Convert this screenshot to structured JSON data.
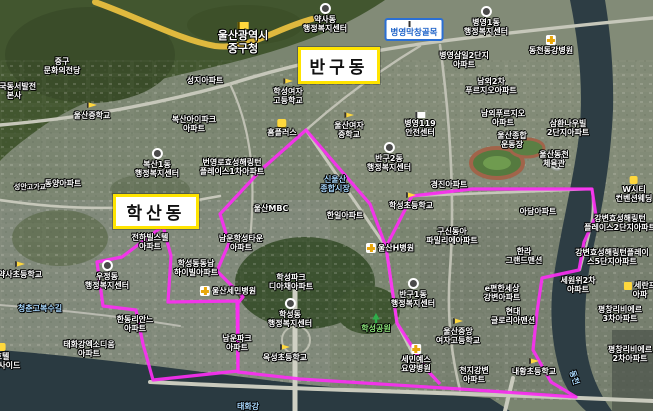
{
  "map": {
    "width": 653,
    "height": 411,
    "description": "satellite-map-ulsan-junggu"
  },
  "colors": {
    "boundary": "#fb2ef2",
    "district_box_border": "#ffe400",
    "district_box_bg": "#ffffff",
    "label_white": "#ffffff",
    "label_blue": "#a9d9ff",
    "label_green": "#8fe97d",
    "road_yellow": "#dfb93e",
    "road_gray": "#c6c7ba",
    "water": "#2a3a41"
  },
  "district_boxes": [
    {
      "name": "bangu-dong-box",
      "label": "반구동",
      "x": 298,
      "y": 47,
      "w": 76,
      "h": 31
    },
    {
      "name": "haksan-dong-box",
      "label": "학산동",
      "x": 113,
      "y": 194,
      "w": 80,
      "h": 29
    }
  ],
  "boundaries": [
    {
      "name": "haksan-dong-boundary",
      "closed": true,
      "points": [
        [
          163,
          226
        ],
        [
          171,
          256
        ],
        [
          168,
          302
        ],
        [
          237,
          301
        ],
        [
          238,
          371
        ],
        [
          153,
          380
        ],
        [
          143,
          344
        ],
        [
          136,
          310
        ],
        [
          103,
          306
        ],
        [
          97,
          262
        ],
        [
          122,
          257
        ]
      ]
    },
    {
      "name": "bangu-dong-boundary",
      "closed": true,
      "points": [
        [
          306,
          130
        ],
        [
          370,
          204
        ],
        [
          386,
          247
        ],
        [
          412,
          196
        ],
        [
          472,
          189
        ],
        [
          592,
          189
        ],
        [
          596,
          216
        ],
        [
          584,
          242
        ],
        [
          579,
          270
        ],
        [
          542,
          278
        ],
        [
          537,
          312
        ],
        [
          533,
          350
        ],
        [
          551,
          382
        ],
        [
          576,
          397
        ],
        [
          460,
          389
        ],
        [
          300,
          379
        ],
        [
          238,
          372
        ],
        [
          238,
          303
        ],
        [
          243,
          297
        ],
        [
          217,
          271
        ],
        [
          229,
          243
        ],
        [
          220,
          214
        ],
        [
          262,
          169
        ]
      ]
    },
    {
      "name": "bangu-inner-divider",
      "closed": false,
      "points": [
        [
          386,
          247
        ],
        [
          393,
          295
        ],
        [
          397,
          323
        ],
        [
          427,
          370
        ],
        [
          440,
          384
        ]
      ]
    }
  ],
  "labels": [
    {
      "text": [
        "중구",
        "문화의전당"
      ],
      "x": 62,
      "y": 57
    },
    {
      "text": [
        "한국동서발전",
        "본사"
      ],
      "x": 14,
      "y": 82
    },
    {
      "text": [
        "울산중학교"
      ],
      "x": 92,
      "y": 102,
      "icon": "school"
    },
    {
      "text": [
        "성지아파트"
      ],
      "x": 205,
      "y": 76
    },
    {
      "text": [
        "복산아이파크",
        "아파트"
      ],
      "x": 194,
      "y": 115
    },
    {
      "text": [
        "울산광역시",
        "중구청"
      ],
      "x": 243,
      "y": 22,
      "size": 11,
      "icon": "gov"
    },
    {
      "text": [
        "약사동",
        "행정복지센터"
      ],
      "x": 325,
      "y": 3,
      "icon": "office"
    },
    {
      "text": [
        "병영막창골목"
      ],
      "x": 414,
      "y": 18,
      "icon": "flag",
      "box": "blue"
    },
    {
      "text": [
        "병영1동",
        "행정복지센터"
      ],
      "x": 486,
      "y": 6,
      "icon": "office"
    },
    {
      "text": [
        "동천동강병원"
      ],
      "x": 551,
      "y": 35,
      "icon": "hospital"
    },
    {
      "text": [
        "병영삼일2단지",
        "아파트"
      ],
      "x": 464,
      "y": 51
    },
    {
      "text": [
        "남외2차",
        "푸르지오아파트"
      ],
      "x": 491,
      "y": 77
    },
    {
      "text": [
        "남외푸르지오",
        "아파트"
      ],
      "x": 503,
      "y": 109
    },
    {
      "text": [
        "삼환나우빌",
        "2단지아파트"
      ],
      "x": 568,
      "y": 119
    },
    {
      "text": [
        "울산종합",
        "운동장"
      ],
      "x": 512,
      "y": 131
    },
    {
      "text": [
        "울산동천",
        "체육관"
      ],
      "x": 554,
      "y": 150
    },
    {
      "text": [
        "학성여자",
        "고등학교"
      ],
      "x": 288,
      "y": 78,
      "icon": "school"
    },
    {
      "text": [
        "울산여자",
        "중학교"
      ],
      "x": 349,
      "y": 112,
      "icon": "school"
    },
    {
      "text": [
        "홈플러스"
      ],
      "x": 282,
      "y": 119,
      "icon": "cart"
    },
    {
      "text": [
        "병영119",
        "안전센터"
      ],
      "x": 420,
      "y": 112,
      "icon": "flag"
    },
    {
      "text": [
        "반구2동",
        "행정복지센터"
      ],
      "x": 389,
      "y": 142,
      "icon": "office"
    },
    {
      "text": [
        "경진아파트"
      ],
      "x": 449,
      "y": 180
    },
    {
      "text": [
        "W시티",
        "컨벤션웨딩"
      ],
      "x": 634,
      "y": 176,
      "icon": "hotel"
    },
    {
      "text": [
        "복산1동",
        "행정복지센터"
      ],
      "x": 157,
      "y": 148,
      "icon": "office"
    },
    {
      "text": [
        "번영로효성해링턴",
        "플레이스1차아파트"
      ],
      "x": 232,
      "y": 158
    },
    {
      "text": [
        "동양아파트"
      ],
      "x": 63,
      "y": 179
    },
    {
      "text": [
        "성안고가교"
      ],
      "x": 30,
      "y": 183,
      "size": 7
    },
    {
      "text": [
        "울산MBC"
      ],
      "x": 271,
      "y": 204
    },
    {
      "text": [
        "신울산",
        "종합시장"
      ],
      "x": 335,
      "y": 175,
      "color": "blue"
    },
    {
      "text": [
        "한일아파트"
      ],
      "x": 345,
      "y": 211
    },
    {
      "text": [
        "학성초등학교"
      ],
      "x": 411,
      "y": 192,
      "icon": "school"
    },
    {
      "text": [
        "구신동아",
        "파밀리에아파트"
      ],
      "x": 452,
      "y": 227
    },
    {
      "text": [
        "울산H병원"
      ],
      "x": 390,
      "y": 243,
      "icon": "hospital-left"
    },
    {
      "text": [
        "아담아파트"
      ],
      "x": 538,
      "y": 207
    },
    {
      "text": [
        "강변효성해링턴",
        "플레이스2단지아파트"
      ],
      "x": 620,
      "y": 214
    },
    {
      "text": [
        "강변효성해링턴플레이",
        "스5단지아파트"
      ],
      "x": 612,
      "y": 248
    },
    {
      "text": [
        "한라",
        "그랜드맨션"
      ],
      "x": 524,
      "y": 247
    },
    {
      "text": [
        "세원위2차",
        "아파트"
      ],
      "x": 578,
      "y": 276
    },
    {
      "text": [
        "세란프",
        "아파"
      ],
      "x": 640,
      "y": 281,
      "icon": "shop-left"
    },
    {
      "text": [
        "평창리비에르",
        "3차아파트"
      ],
      "x": 620,
      "y": 305
    },
    {
      "text": [
        "평창리비에르",
        "2차아파트"
      ],
      "x": 630,
      "y": 345
    },
    {
      "text": [
        "e편한세상",
        "강변아파트"
      ],
      "x": 502,
      "y": 284
    },
    {
      "text": [
        "현대",
        "글로리아맨션"
      ],
      "x": 513,
      "y": 307
    },
    {
      "text": [
        "울산중앙",
        "여자고등학교"
      ],
      "x": 458,
      "y": 318,
      "icon": "school"
    },
    {
      "text": [
        "천지강변",
        "아파트"
      ],
      "x": 474,
      "y": 366
    },
    {
      "text": [
        "내황초등학교"
      ],
      "x": 534,
      "y": 358,
      "icon": "school"
    },
    {
      "text": [
        "동천"
      ],
      "x": 574,
      "y": 373,
      "color": "blue",
      "rotate": 72
    },
    {
      "text": [
        "반구1동",
        "행정복지센터"
      ],
      "x": 413,
      "y": 278,
      "icon": "office"
    },
    {
      "text": [
        "학성공원"
      ],
      "x": 376,
      "y": 313,
      "color": "green",
      "icon": "tree"
    },
    {
      "text": [
        "세민예스",
        "요양병원"
      ],
      "x": 416,
      "y": 344,
      "icon": "hospital"
    },
    {
      "text": [
        "울산세민병원"
      ],
      "x": 228,
      "y": 286,
      "icon": "hospital-left"
    },
    {
      "text": [
        "학성동동남",
        "하이빌아파트"
      ],
      "x": 196,
      "y": 259
    },
    {
      "text": [
        "전하빌스텔",
        "아파트"
      ],
      "x": 150,
      "y": 233
    },
    {
      "text": [
        "남운학성타운",
        "아파트"
      ],
      "x": 241,
      "y": 234
    },
    {
      "text": [
        "우정동",
        "행정복지센터"
      ],
      "x": 107,
      "y": 260,
      "icon": "office"
    },
    {
      "text": [
        "한동리안느",
        "아파트"
      ],
      "x": 135,
      "y": 315
    },
    {
      "text": [
        "태화강엑소디움",
        "아파트"
      ],
      "x": 89,
      "y": 340
    },
    {
      "text": [
        "호텔",
        "리버사이드"
      ],
      "x": 2,
      "y": 343,
      "icon": "hotel"
    },
    {
      "text": [
        "약사초등학교"
      ],
      "x": 20,
      "y": 261,
      "icon": "school"
    },
    {
      "text": [
        "청춘고복수길"
      ],
      "x": 40,
      "y": 304,
      "color": "blue"
    },
    {
      "text": [
        "학성파크",
        "디아채아파트"
      ],
      "x": 291,
      "y": 273
    },
    {
      "text": [
        "학성동",
        "행정복지센터"
      ],
      "x": 290,
      "y": 298,
      "icon": "office"
    },
    {
      "text": [
        "남운파크",
        "아파트"
      ],
      "x": 237,
      "y": 334
    },
    {
      "text": [
        "옥성초등학교"
      ],
      "x": 285,
      "y": 344,
      "icon": "school"
    },
    {
      "text": [
        "태화강"
      ],
      "x": 248,
      "y": 402,
      "color": "blue"
    }
  ]
}
